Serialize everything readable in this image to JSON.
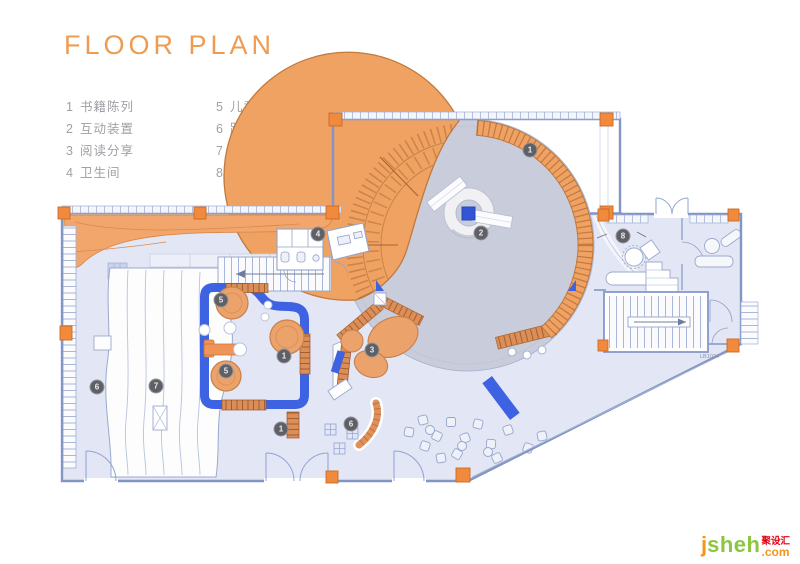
{
  "title": "FLOOR PLAN",
  "legend": {
    "columns": [
      {
        "items": [
          {
            "num": "1",
            "label": "书籍陈列"
          },
          {
            "num": "2",
            "label": "互动装置"
          },
          {
            "num": "3",
            "label": "阅读分享"
          },
          {
            "num": "4",
            "label": "卫生间"
          }
        ]
      },
      {
        "items": [
          {
            "num": "5",
            "label": "儿童阅读区"
          },
          {
            "num": "6",
            "label": "路演区"
          },
          {
            "num": "7",
            "label": "阶梯室阅读区"
          },
          {
            "num": "8",
            "label": "咖啡吧"
          }
        ]
      }
    ]
  },
  "markers": [
    {
      "num": "1",
      "x": 530,
      "y": 150
    },
    {
      "num": "2",
      "x": 481,
      "y": 233
    },
    {
      "num": "4",
      "x": 318,
      "y": 234
    },
    {
      "num": "8",
      "x": 623,
      "y": 236
    },
    {
      "num": "5",
      "x": 221,
      "y": 300
    },
    {
      "num": "1",
      "x": 284,
      "y": 356
    },
    {
      "num": "5",
      "x": 226,
      "y": 371
    },
    {
      "num": "3",
      "x": 372,
      "y": 350
    },
    {
      "num": "1",
      "x": 281,
      "y": 429
    },
    {
      "num": "6",
      "x": 351,
      "y": 424
    },
    {
      "num": "7",
      "x": 156,
      "y": 386
    },
    {
      "num": "6",
      "x": 97,
      "y": 387
    }
  ],
  "plan": {
    "room_label": "LB1024"
  },
  "watermark": {
    "j": "j",
    "sheh": "sheh",
    "cn": "聚设汇",
    "com": ".com"
  },
  "colors": {
    "accent_orange": "#EE9C52",
    "furniture_orange": "#F0A263",
    "plan_blue": "#3D63E2",
    "floor_lavender": "#E3E6F4",
    "rotunda_gray": "#C9CDDB",
    "marker_gray": "#5F6066",
    "watermark_green": "#8CC63E",
    "watermark_orange": "#F7941D",
    "watermark_red": "#E60012"
  }
}
